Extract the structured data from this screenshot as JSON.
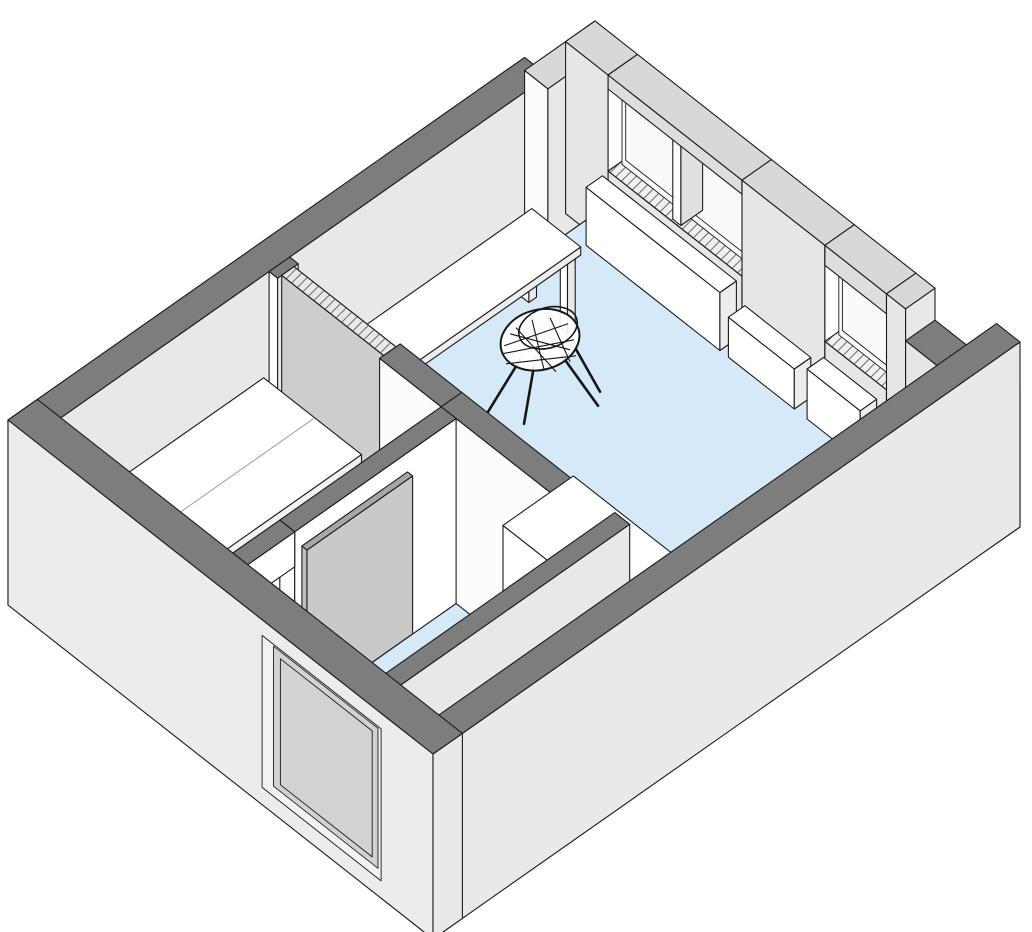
{
  "meta": {
    "title": "Isometric cutaway floor plan of a studio apartment",
    "view": "axonometric section view, walls cut at lintel height",
    "rooms": [
      "main-room",
      "bedroom",
      "bathroom",
      "entry-hall"
    ]
  },
  "canvas": {
    "width": 1032,
    "height": 932,
    "background": "#ffffff"
  },
  "colors": {
    "line": "#1b1b1b",
    "topDark": "#7d7d7d",
    "topLight": "#d8d8d8",
    "extSW": "#ececec",
    "extSE": "#e9e9e9",
    "intSW": "#fcfcfc",
    "intSE": "#e8e8e8",
    "intNE": "#e6e6e6",
    "white": "#ffffff",
    "floor": "#d6e9f8",
    "glass": "#f8fafc",
    "sill": "#f0f0f0",
    "doorGray": "#c9c9c9",
    "doorEdge": "#b2b2b2",
    "pocketTop": "#e8e8e8",
    "panelGray": "#d2d2d2",
    "chairInk": "#161616"
  },
  "projection": {
    "origin": [
      8,
      420
    ],
    "ex": [
      587,
      -412
    ],
    "ev": [
      425,
      334
    ],
    "wallHeight": 185,
    "floorLevel": 14
  },
  "scene": [
    {
      "id": "nw-wall-main",
      "shape": "box",
      "u": [
        0,
        0.88
      ],
      "v": [
        0,
        0.055
      ],
      "h": [
        0,
        185
      ],
      "top": "topDark",
      "left": "extSW",
      "right": "intSE"
    },
    {
      "id": "nw-wall-end",
      "shape": "box",
      "u": [
        0.88,
        1
      ],
      "v": [
        0,
        0.055
      ],
      "h": [
        0,
        172
      ],
      "top": "topLight",
      "left": "intSW",
      "right": "intSE"
    },
    {
      "id": "ne-wall-left",
      "shape": "box",
      "u": [
        0.95,
        1
      ],
      "v": [
        0,
        0.1
      ],
      "h": [
        0,
        172
      ],
      "top": "topLight",
      "left": "intNE",
      "right": "white"
    },
    {
      "id": "window-sill-main",
      "shape": "box",
      "u": [
        0.95,
        1
      ],
      "v": [
        0.1,
        0.415
      ],
      "h": [
        0,
        76
      ],
      "top": "sill",
      "hatch": true,
      "left": "intNE",
      "right": "white"
    },
    {
      "id": "window-1-glass",
      "shape": "face",
      "plane": "u",
      "at": 0.97,
      "v": [
        0.105,
        0.248
      ],
      "h": [
        76,
        158
      ],
      "fill": "glass"
    },
    {
      "id": "window-1-frame",
      "shape": "face",
      "plane": "u",
      "at": 0.969,
      "v": [
        0.115,
        0.238
      ],
      "h": [
        84,
        150
      ],
      "fill": "none"
    },
    {
      "id": "window-2-glass",
      "shape": "face",
      "plane": "u",
      "at": 0.97,
      "v": [
        0.267,
        0.41
      ],
      "h": [
        76,
        158
      ],
      "fill": "glass"
    },
    {
      "id": "window-2-frame",
      "shape": "face",
      "plane": "u",
      "at": 0.969,
      "v": [
        0.277,
        0.4
      ],
      "h": [
        84,
        150
      ],
      "fill": "none"
    },
    {
      "id": "window-mullion",
      "shape": "box",
      "u": [
        0.953,
        0.99
      ],
      "v": [
        0.248,
        0.267
      ],
      "h": [
        76,
        158
      ],
      "top": "white",
      "left": "white",
      "right": "#e0e0e0"
    },
    {
      "id": "window-lintel-main",
      "shape": "box",
      "u": [
        0.95,
        1
      ],
      "v": [
        0.1,
        0.415
      ],
      "h": [
        158,
        172
      ],
      "top": "topLight",
      "left": "#dedede",
      "right": "white"
    },
    {
      "id": "ne-wall-pier",
      "shape": "box",
      "u": [
        0.95,
        1
      ],
      "v": [
        0.415,
        0.61
      ],
      "h": [
        0,
        172
      ],
      "top": "topLight",
      "left": "intNE",
      "right": "white"
    },
    {
      "id": "window-sill-right",
      "shape": "box",
      "u": [
        0.95,
        1
      ],
      "v": [
        0.61,
        0.755
      ],
      "h": [
        0,
        76
      ],
      "top": "sill",
      "hatch": true,
      "left": "intNE",
      "right": "white"
    },
    {
      "id": "window-3-glass",
      "shape": "face",
      "plane": "u",
      "at": 0.97,
      "v": [
        0.615,
        0.75
      ],
      "h": [
        76,
        152
      ],
      "fill": "glass"
    },
    {
      "id": "window-3-frame",
      "shape": "face",
      "plane": "u",
      "at": 0.969,
      "v": [
        0.625,
        0.74
      ],
      "h": [
        84,
        144
      ],
      "fill": "none"
    },
    {
      "id": "window-lintel-right",
      "shape": "box",
      "u": [
        0.95,
        1
      ],
      "v": [
        0.61,
        0.755
      ],
      "h": [
        152,
        172
      ],
      "top": "topLight",
      "left": "#dedede",
      "right": "white"
    },
    {
      "id": "ne-wall-jamb",
      "shape": "box",
      "u": [
        0.95,
        1
      ],
      "v": [
        0.755,
        0.8
      ],
      "h": [
        0,
        172
      ],
      "top": "topLight",
      "left": "intNE",
      "right": "extSE"
    },
    {
      "id": "ne-wall-corner-low",
      "shape": "box",
      "u": [
        0.95,
        1
      ],
      "v": [
        0.8,
        1
      ],
      "h": [
        0,
        140
      ],
      "top": "topDark",
      "left": "intNE",
      "right": "extSE"
    },
    {
      "id": "floor-main-room",
      "shape": "floor",
      "pts": [
        [
          0.44,
          0.055
        ],
        [
          0.95,
          0.055
        ],
        [
          0.95,
          0.945
        ],
        [
          0.05,
          0.945
        ],
        [
          0.05,
          0.855
        ],
        [
          0.44,
          0.855
        ]
      ],
      "h": 14,
      "fill": "floor"
    },
    {
      "id": "floor-bedroom",
      "shape": "floor",
      "pts": [
        [
          0.05,
          0.055
        ],
        [
          0.405,
          0.055
        ],
        [
          0.405,
          0.46
        ],
        [
          0.05,
          0.46
        ]
      ],
      "h": 14,
      "fill": "floor"
    },
    {
      "id": "floor-bathroom",
      "shape": "floor",
      "pts": [
        [
          0.05,
          0.495
        ],
        [
          0.405,
          0.495
        ],
        [
          0.405,
          0.82
        ],
        [
          0.05,
          0.82
        ]
      ],
      "h": 14,
      "fill": "floor"
    },
    {
      "id": "radiator-main",
      "shape": "box",
      "u": [
        0.916,
        0.944
      ],
      "v": [
        0.095,
        0.41
      ],
      "h": [
        14,
        72
      ],
      "top": "white",
      "left": "white",
      "right": "#ededed"
    },
    {
      "id": "radiator-bench",
      "shape": "box",
      "u": [
        0.916,
        0.944
      ],
      "v": [
        0.43,
        0.585
      ],
      "h": [
        14,
        54
      ],
      "top": "white",
      "left": "white",
      "right": "#ededed"
    },
    {
      "id": "radiator-right",
      "shape": "box",
      "u": [
        0.916,
        0.944
      ],
      "v": [
        0.615,
        0.74
      ],
      "h": [
        14,
        64
      ],
      "top": "white",
      "left": "white",
      "right": "#ededed"
    },
    {
      "id": "cabinet-east-corner",
      "shape": "box",
      "u": [
        0.88,
        0.945
      ],
      "v": [
        0.8,
        0.93
      ],
      "h": [
        14,
        66
      ],
      "top": "white",
      "left": "white",
      "right": "#ededed"
    },
    {
      "id": "desk-leg-back-left",
      "shape": "box",
      "u": [
        0.528,
        0.541
      ],
      "v": [
        0.105,
        0.122
      ],
      "h": [
        14,
        84
      ],
      "top": "white",
      "left": "white",
      "right": "#e8e8e8"
    },
    {
      "id": "desk-leg-back-right",
      "shape": "box",
      "u": [
        0.799,
        0.812
      ],
      "v": [
        0.105,
        0.122
      ],
      "h": [
        14,
        84
      ],
      "top": "white",
      "left": "white",
      "right": "#e8e8e8"
    },
    {
      "id": "desk-leg-front-left",
      "shape": "box",
      "u": [
        0.528,
        0.541
      ],
      "v": [
        0.196,
        0.213
      ],
      "h": [
        14,
        84
      ],
      "top": "white",
      "left": "white",
      "right": "#e8e8e8"
    },
    {
      "id": "desk-leg-front-right",
      "shape": "box",
      "u": [
        0.799,
        0.812
      ],
      "v": [
        0.196,
        0.213
      ],
      "h": [
        14,
        84
      ],
      "top": "white",
      "left": "white",
      "right": "#e8e8e8"
    },
    {
      "id": "desk-top",
      "shape": "box",
      "u": [
        0.52,
        0.82
      ],
      "v": [
        0.1,
        0.215
      ],
      "h": [
        84,
        92
      ],
      "top": "white",
      "left": "white",
      "right": "#ededed"
    },
    {
      "id": "desk-chair",
      "shape": "chair",
      "u": 0.7,
      "v": 0.285,
      "seatH": 58,
      "shell": {
        "cx": 0,
        "cy": -14,
        "rx": 40,
        "ry": 30,
        "rot": -15
      },
      "rim": {
        "cx": 8,
        "cy": -26,
        "rx": 30,
        "ry": 20,
        "rot": -18
      },
      "legs": [
        [
          -20,
          6,
          -52,
          58
        ],
        [
          22,
          2,
          58,
          52
        ],
        [
          -6,
          12,
          -16,
          70
        ],
        [
          34,
          -8,
          60,
          38
        ]
      ],
      "wires": [
        [
          -36,
          -8,
          28,
          -30
        ],
        [
          -38,
          0,
          34,
          -14
        ],
        [
          -34,
          10,
          36,
          2
        ],
        [
          -24,
          -26,
          16,
          18
        ],
        [
          -8,
          -34,
          4,
          16
        ],
        [
          10,
          -36,
          30,
          8
        ],
        [
          -30,
          -20,
          30,
          -4
        ]
      ]
    },
    {
      "id": "partition-bedroom-stub",
      "shape": "box",
      "u": [
        0.405,
        0.44
      ],
      "v": [
        0.055,
        0.075
      ],
      "h": [
        0,
        185
      ],
      "top": "topDark",
      "left": "intSW",
      "right": "intSE"
    },
    {
      "id": "pocket-sliding-door",
      "shape": "box",
      "u": [
        0.412,
        0.433
      ],
      "v": [
        0.075,
        0.315
      ],
      "h": [
        0,
        185
      ],
      "top": "pocketTop",
      "hatch": true,
      "left": "#cdcdcd",
      "right": "#bfbfbf"
    },
    {
      "id": "partition-bedroom-solid",
      "shape": "box",
      "u": [
        0.405,
        0.44
      ],
      "v": [
        0.315,
        0.46
      ],
      "h": [
        0,
        185
      ],
      "top": "topDark",
      "left": "intSW",
      "right": "white"
    },
    {
      "id": "partition-bathroom-east",
      "shape": "box",
      "u": [
        0.405,
        0.44
      ],
      "v": [
        0.46,
        0.82
      ],
      "h": [
        0,
        185
      ],
      "top": "topDark",
      "left": "intSW",
      "right": "intSE"
    },
    {
      "id": "kitchen-counter",
      "shape": "box",
      "u": [
        0.445,
        0.565
      ],
      "v": [
        0.55,
        0.78
      ],
      "h": [
        14,
        80
      ],
      "top": "white",
      "left": "white",
      "right": "#ededed"
    },
    {
      "id": "bed-platform",
      "shape": "box",
      "u": [
        0.07,
        0.385
      ],
      "v": [
        0.07,
        0.3
      ],
      "h": [
        14,
        92
      ],
      "top": "white",
      "left": "intSW",
      "right": "#f2f2f2"
    },
    {
      "id": "bed-ledge",
      "shape": "box",
      "u": [
        0.07,
        0.385
      ],
      "v": [
        0.3,
        0.42
      ],
      "h": [
        14,
        62
      ],
      "top": "white",
      "left": "intSW",
      "right": "#f2f2f2"
    },
    {
      "id": "bed-split-line",
      "shape": "line3",
      "pts": [
        [
          0.07,
          0.19,
          92
        ],
        [
          0.385,
          0.19,
          92
        ]
      ],
      "stroke": "#9f9f9f",
      "w": 1
    },
    {
      "id": "partition-bathroom-north",
      "shape": "box",
      "u": [
        0.13,
        0.405
      ],
      "v": [
        0.46,
        0.495
      ],
      "h": [
        0,
        185
      ],
      "top": "topDark",
      "left": "intSW",
      "right": "white"
    },
    {
      "id": "bathroom-door-lintel",
      "shape": "box",
      "u": [
        0.05,
        0.13
      ],
      "v": [
        0.46,
        0.495
      ],
      "h": [
        150,
        185
      ],
      "top": "topDark",
      "left": "intSW",
      "right": "white"
    },
    {
      "id": "bathroom-door-open",
      "shape": "box",
      "u": [
        0.135,
        0.315
      ],
      "v": [
        0.505,
        0.517
      ],
      "h": [
        14,
        172
      ],
      "top": "#a6a6a6",
      "left": "#c0c0c0",
      "right": "doorGray"
    },
    {
      "id": "partition-hall-south",
      "shape": "box",
      "u": [
        0.05,
        0.44
      ],
      "v": [
        0.82,
        0.855
      ],
      "h": [
        0,
        185
      ],
      "top": "topDark",
      "left": "intSW",
      "right": "intSE"
    },
    {
      "id": "se-wall",
      "shape": "box",
      "u": [
        0,
        1
      ],
      "v": [
        0.945,
        1
      ],
      "h": [
        0,
        185
      ],
      "top": "topDark",
      "left": "extSW",
      "right": "extSE"
    },
    {
      "id": "sw-wall",
      "shape": "box",
      "u": [
        0,
        0.05
      ],
      "v": [
        0,
        1
      ],
      "h": [
        0,
        185
      ],
      "top": "topDark",
      "left": "extSW",
      "right": "extSE"
    },
    {
      "id": "entry-door-recess",
      "shape": "face",
      "plane": "u",
      "at": 0.013,
      "v": [
        0.58,
        0.86
      ],
      "h": [
        6,
        158
      ],
      "fill": "#f2f2f2"
    },
    {
      "id": "entry-door-panel",
      "shape": "face",
      "plane": "u",
      "at": 0.02,
      "v": [
        0.597,
        0.843
      ],
      "h": [
        10,
        150
      ],
      "fill": "panelGray"
    },
    {
      "id": "entry-door-inner-line",
      "shape": "face",
      "plane": "u",
      "at": 0.021,
      "v": [
        0.612,
        0.828
      ],
      "h": [
        16,
        142
      ],
      "fill": "none"
    }
  ]
}
